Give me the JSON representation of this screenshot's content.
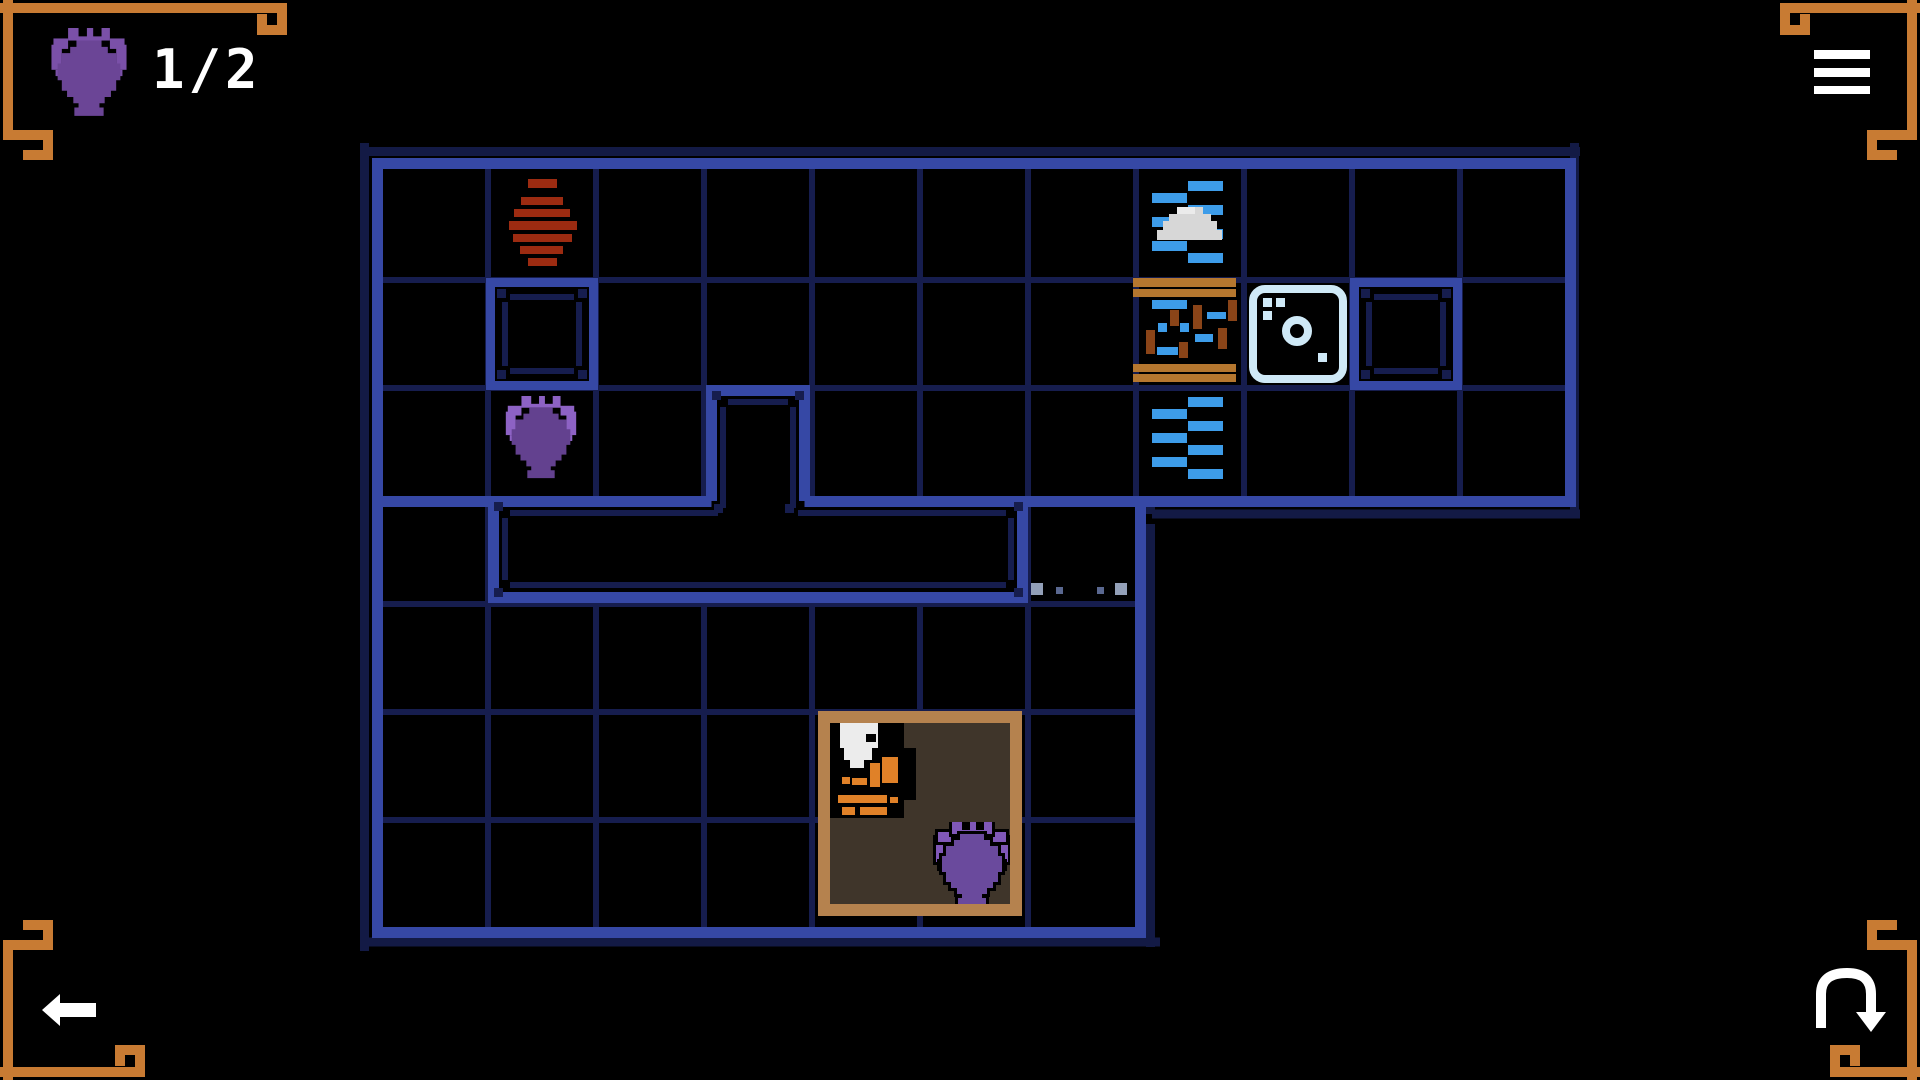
{
  "game": {
    "name": "amphora-puzzle-room",
    "scene": "top-down tile puzzle map"
  },
  "hud": {
    "counter_label": "1/2",
    "counter_icon": "amphora-icon",
    "amphorae_collected": 1,
    "amphorae_total": 2
  },
  "controls": {
    "menu_icon": "hamburger-menu-icon",
    "back_icon": "back-arrow-icon",
    "restart_icon": "restart-undo-icon"
  },
  "map": {
    "grid": {
      "upper_room": {
        "cols": 11,
        "rows": 3
      },
      "lower_room": {
        "cols": 7,
        "rows": 4
      }
    },
    "objects": [
      {
        "name": "striped-clay-pot",
        "tile": "col 2, row 1",
        "color": "#9c2b11"
      },
      {
        "name": "pedestal-slab-a",
        "tile": "col 2, row 2"
      },
      {
        "name": "purple-amphora-field",
        "tile": "col 2, row 3",
        "colors": [
          "#63418f",
          "#8d62c4"
        ]
      },
      {
        "name": "rock-in-water",
        "tile": "col 8, row 1",
        "color": "#d7d7d7"
      },
      {
        "name": "broken-bridge-debris",
        "tile": "col 8, row 2",
        "colors": [
          "#b5772f",
          "#8a4418",
          "#3d9ce9"
        ]
      },
      {
        "name": "water",
        "tile": "col 8, rows 1 and 3",
        "color": "#3d9ce9"
      },
      {
        "name": "ice-die-block",
        "tile": "col 9, row 2",
        "color": "#cfe9f7"
      },
      {
        "name": "pedestal-slab-b",
        "tile": "col 10, row 2"
      },
      {
        "name": "wall-stub-alcove",
        "tile": "col 4, row 3"
      },
      {
        "name": "long-wall-slab",
        "tile": "cols 2-5, row 4"
      },
      {
        "name": "pebble-trail",
        "tile": "cols 6-7, row 4",
        "colors": [
          "#93a0b8",
          "#5a6890"
        ]
      },
      {
        "name": "hut",
        "tile": "cols 5-6, rows 6-7",
        "frame_color": "#b5824e",
        "floor_color": "#3f352a",
        "contents": [
          "player-character",
          "purple-amphora-outlined"
        ]
      }
    ]
  },
  "colors": {
    "background": "#000000",
    "grid_line": "#161d4e",
    "wall_bright": "#3648a5",
    "wall_outer_dark": "#131a45",
    "ornament_orange": "#c87b33",
    "hud_white": "#ffffff",
    "amphora_hud": "#6b4596",
    "amphora_body": "#63418f",
    "amphora_light": "#8d62c4",
    "water_blue": "#3d9ce9",
    "ice_blue": "#cfe9f7",
    "wood_bar": "#b5772f",
    "wood_stick": "#8a4418",
    "pot_red": "#9c2b11",
    "rock_gray": "#d7d7d7",
    "hut_frame": "#b5824e",
    "hut_floor": "#3f352a",
    "character_orange": "#e08128"
  }
}
